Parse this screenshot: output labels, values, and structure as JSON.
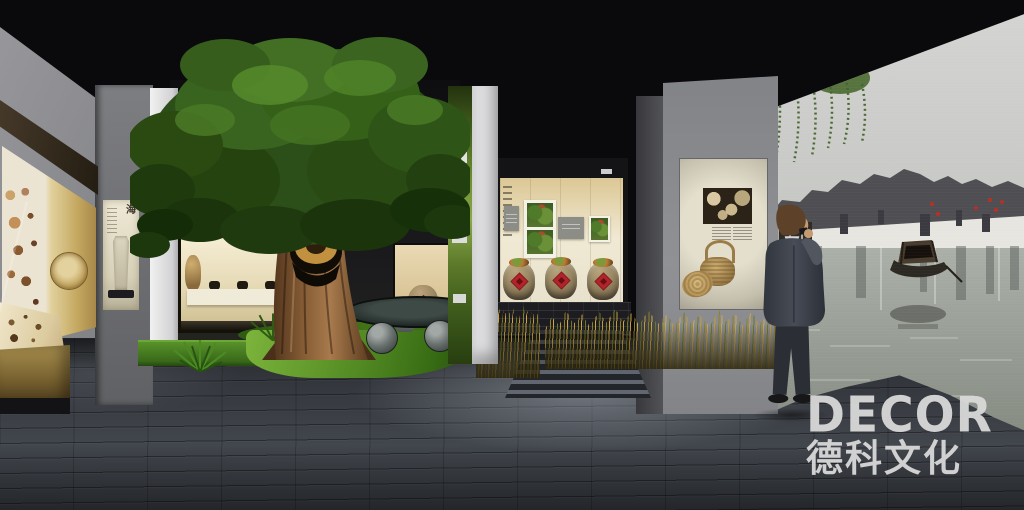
{
  "watermark": {
    "brand": "DECOR",
    "company": "德科文化"
  },
  "exhibit_text": {
    "stele_calligraphy": "海"
  },
  "palette": {
    "ceiling": "#0a0a0c",
    "accent-red": "#b3242a",
    "gold": "#c4a860",
    "grass": "#578f26",
    "canopy": "#3a6420",
    "wall-gray": "#909195",
    "warm-light": "#f0e9d3",
    "floor": "#3c4046",
    "logo": "#d9d9d9"
  },
  "scene": {
    "description": "3D rendering of a folk-culture museum exhibition hall",
    "left_display": "gold vitrine with household artifacts and a round winnowing basket",
    "stele_niche": "lit niche with stone stele and calligraphy banner",
    "tree_exhibit": "old tree with straw rain cape, stone table and drum stools on a grass mound",
    "center_display": "lit alcove with photo panels and three glazed jars with red diamond labels",
    "right_display": "wall panel with sepia photograph, captions and woven baskets",
    "mural": "photographic mural of a Jiangnan water town with canal boat and willow",
    "visitor": "man in a dark suit photographing the mural"
  }
}
